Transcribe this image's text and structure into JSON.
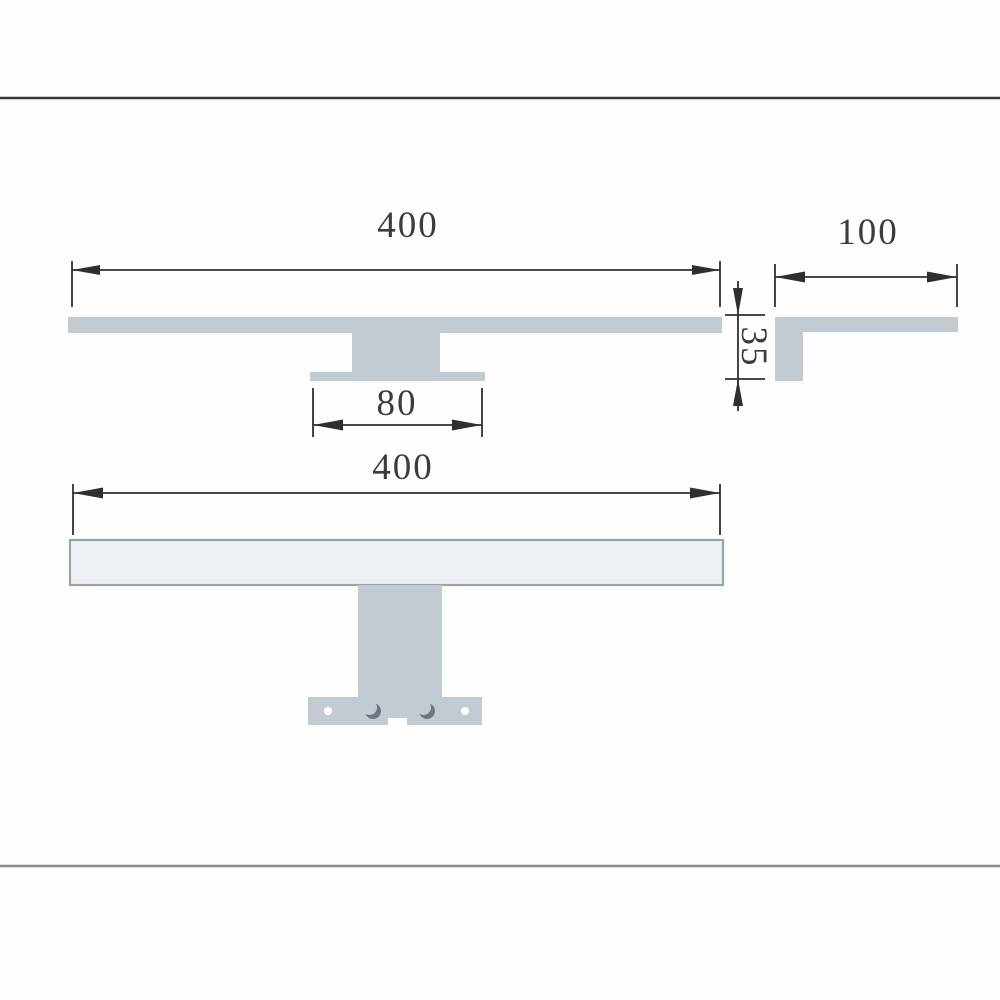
{
  "page": {
    "background": "#fdfdfd"
  },
  "colors": {
    "rule_top": "#3a3a3a",
    "rule_bottom": "#8c8c8c",
    "solid_fill": "#c2cbd2",
    "tube_fill": "#eef1f3",
    "tube_stroke": "#9aa3aa",
    "line": "#2f2f2f",
    "label_text": "#3c3c3c",
    "hole_ring": "#6e7682",
    "hole_fill": "#ffffff"
  },
  "views": {
    "profile": {
      "width_label": "400",
      "height_label": "35",
      "mount_width_label": "80"
    },
    "side": {
      "depth_label": "100"
    },
    "front": {
      "width_label": "400"
    }
  }
}
